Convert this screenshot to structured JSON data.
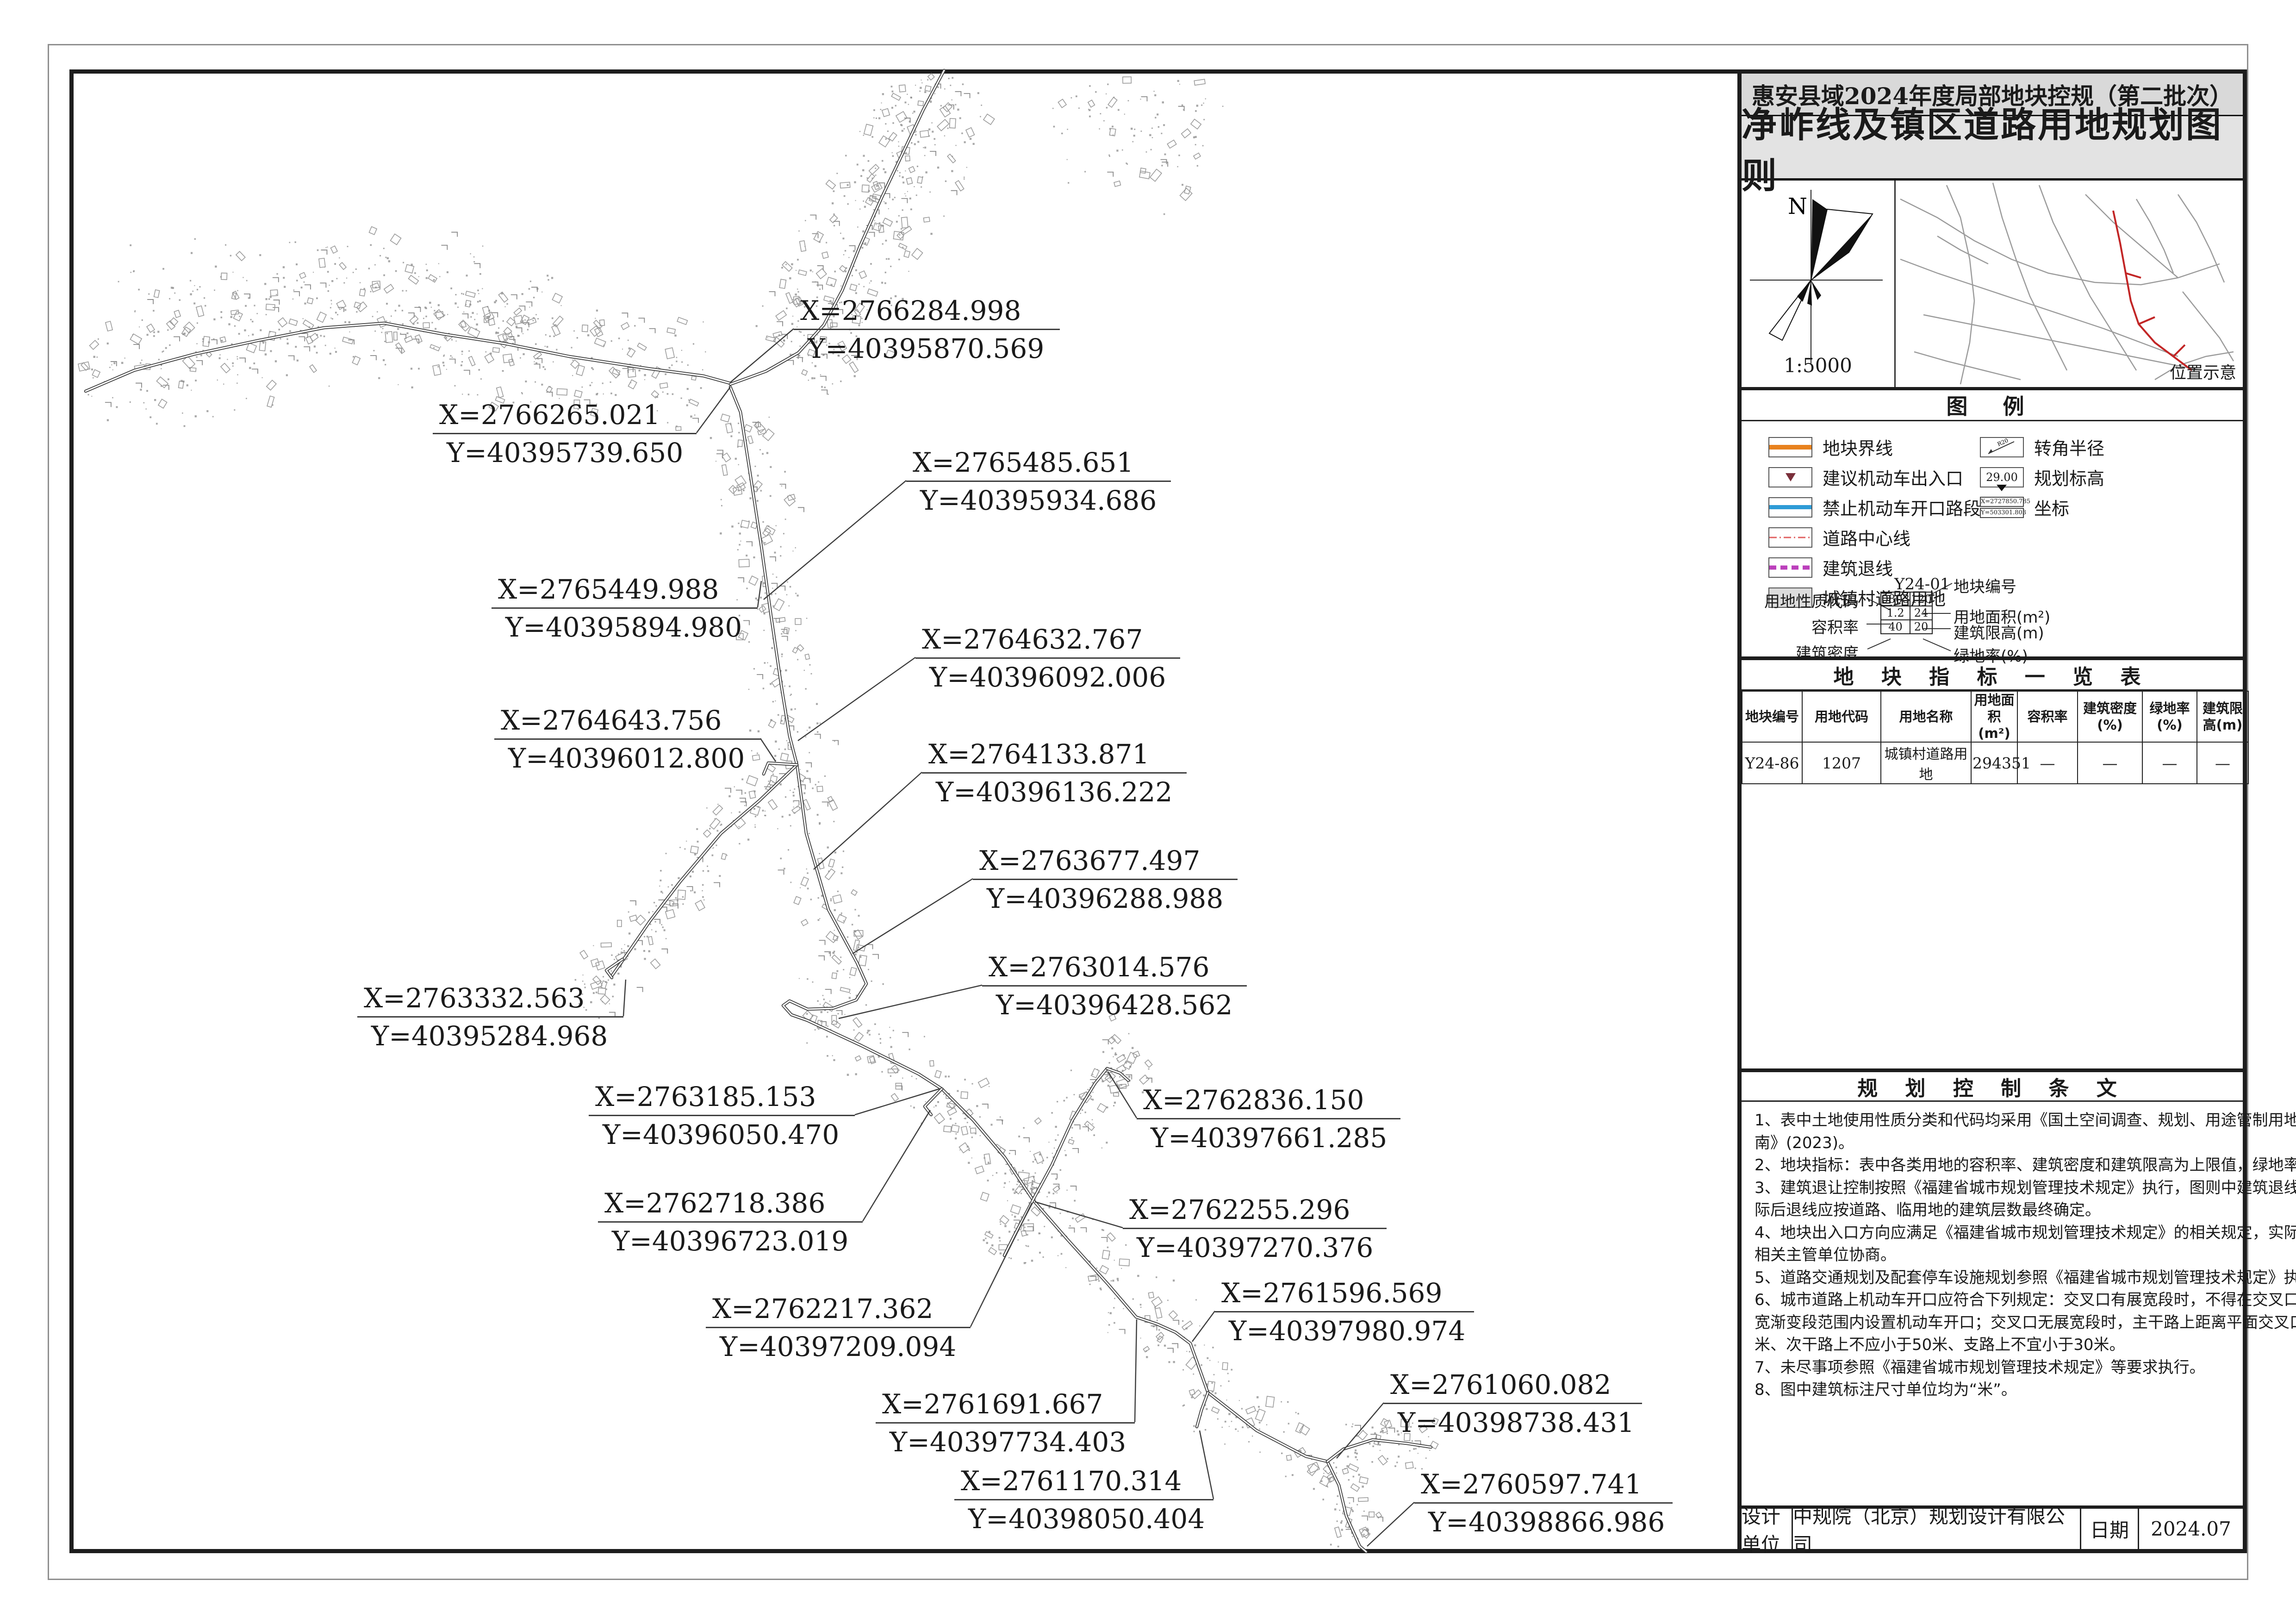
{
  "titlebar": {
    "project": "惠安县域2024年度局部地块控规（第二批次）",
    "sheet_title": "净岞线及镇区道路用地规划图则"
  },
  "north": {
    "label": "N",
    "scale": "1:5000"
  },
  "location_map": {
    "caption": "位置示意"
  },
  "legend": {
    "title": "图 例",
    "left_items": [
      {
        "label": "地块界线"
      },
      {
        "label": "建议机动车出入口"
      },
      {
        "label": "禁止机动车开口路段"
      },
      {
        "label": "道路中心线"
      },
      {
        "label": "建筑退线"
      },
      {
        "label": "城镇村道路用地"
      }
    ],
    "right_items": [
      {
        "label": "转角半径",
        "icon_text": "R20"
      },
      {
        "label": "规划标高",
        "value": "29.00"
      },
      {
        "label": "坐标",
        "x": "X=2727850.785",
        "y": "Y=503301.803"
      }
    ],
    "block_diagram": {
      "plot_no": "Y24-01",
      "labels": {
        "code": "用地性质代码",
        "far": "容积率",
        "density": "建筑密度",
        "plot_no": "地块编号",
        "area": "用地面积(m²)",
        "height": "建筑限高(m)",
        "green": "绿地率(%)"
      },
      "cells": [
        [
          "0803",
          "120"
        ],
        [
          "1.2",
          "24"
        ],
        [
          "40",
          "20"
        ]
      ]
    },
    "colors": {
      "boundary": "#E8821E",
      "no_opening": "#2E9BD6",
      "centerline": "#E06060",
      "setback": "#BB3FBB",
      "road_fill": "#DCDCDC",
      "entrance_triangle": "#7A2F3A"
    }
  },
  "table": {
    "title": "地 块 指 标 一 览 表",
    "headers": [
      "地块编号",
      "用地代码",
      "用地名称",
      "用地面积(m²)",
      "容积率",
      "建筑密度(%)",
      "绿地率(%)",
      "建筑限高(m)"
    ],
    "row": [
      "Y24-86",
      "1207",
      "城镇村道路用地",
      "294351",
      "—",
      "—",
      "—",
      "—"
    ]
  },
  "provisions": {
    "title": "规 划 控 制 条 文",
    "lines": [
      "1、表中土地使用性质分类和代码均采用《国土空间调查、规划、用途管制用地用海分类指",
      "南》(2023)。",
      "2、地块指标：表中各类用地的容积率、建筑密度和建筑限高为上限值，绿地率为下限值。",
      "3、建筑退让控制按照《福建省城市规划管理技术规定》执行，图则中建筑退线为示意，实",
      "际后退线应按道路、临用地的建筑层数最终确定。",
      "4、地块出入口方向应满足《福建省城市规划管理技术规定》的相关规定，实际建设中可与",
      "相关主管单位协商。",
      "5、道路交通规划及配套停车设施规划参照《福建省城市规划管理技术规定》执行。",
      "6、城市道路上机动车开口应符合下列规定：交叉口有展宽段时，不得在交叉口展宽段和展",
      "宽渐变段范围内设置机动车开口；交叉口无展宽段时，主干路上距离平面交叉口不应小于60",
      "米、次干路上不应小于50米、支路上不宜小于30米。",
      "7、未尽事项参照《福建省城市规划管理技术规定》等要求执行。",
      "8、图中建筑标注尺寸单位均为“米”。"
    ]
  },
  "footer": {
    "design_label": "设计单位",
    "design_value": "中规院（北京）规划设计有限公司",
    "date_label": "日期",
    "date_value": "2024.07"
  },
  "callouts": [
    {
      "x": "X=2766284.998",
      "y": "Y=40395870.569"
    },
    {
      "x": "X=2766265.021",
      "y": "Y=40395739.650"
    },
    {
      "x": "X=2765485.651",
      "y": "Y=40395934.686"
    },
    {
      "x": "X=2765449.988",
      "y": "Y=40395894.980"
    },
    {
      "x": "X=2764632.767",
      "y": "Y=40396092.006"
    },
    {
      "x": "X=2764643.756",
      "y": "Y=40396012.800"
    },
    {
      "x": "X=2764133.871",
      "y": "Y=40396136.222"
    },
    {
      "x": "X=2763677.497",
      "y": "Y=40396288.988"
    },
    {
      "x": "X=2763014.576",
      "y": "Y=40396428.562"
    },
    {
      "x": "X=2763332.563",
      "y": "Y=40395284.968"
    },
    {
      "x": "X=2763185.153",
      "y": "Y=40396050.470"
    },
    {
      "x": "X=2762836.150",
      "y": "Y=40397661.285"
    },
    {
      "x": "X=2762718.386",
      "y": "Y=40396723.019"
    },
    {
      "x": "X=2762255.296",
      "y": "Y=40397270.376"
    },
    {
      "x": "X=2762217.362",
      "y": "Y=40397209.094"
    },
    {
      "x": "X=2761596.569",
      "y": "Y=40397980.974"
    },
    {
      "x": "X=2761691.667",
      "y": "Y=40397734.403"
    },
    {
      "x": "X=2761060.082",
      "y": "Y=40398738.431"
    },
    {
      "x": "X=2761170.314",
      "y": "Y=40398050.404"
    },
    {
      "x": "X=2760597.741",
      "y": "Y=40398866.986"
    }
  ]
}
